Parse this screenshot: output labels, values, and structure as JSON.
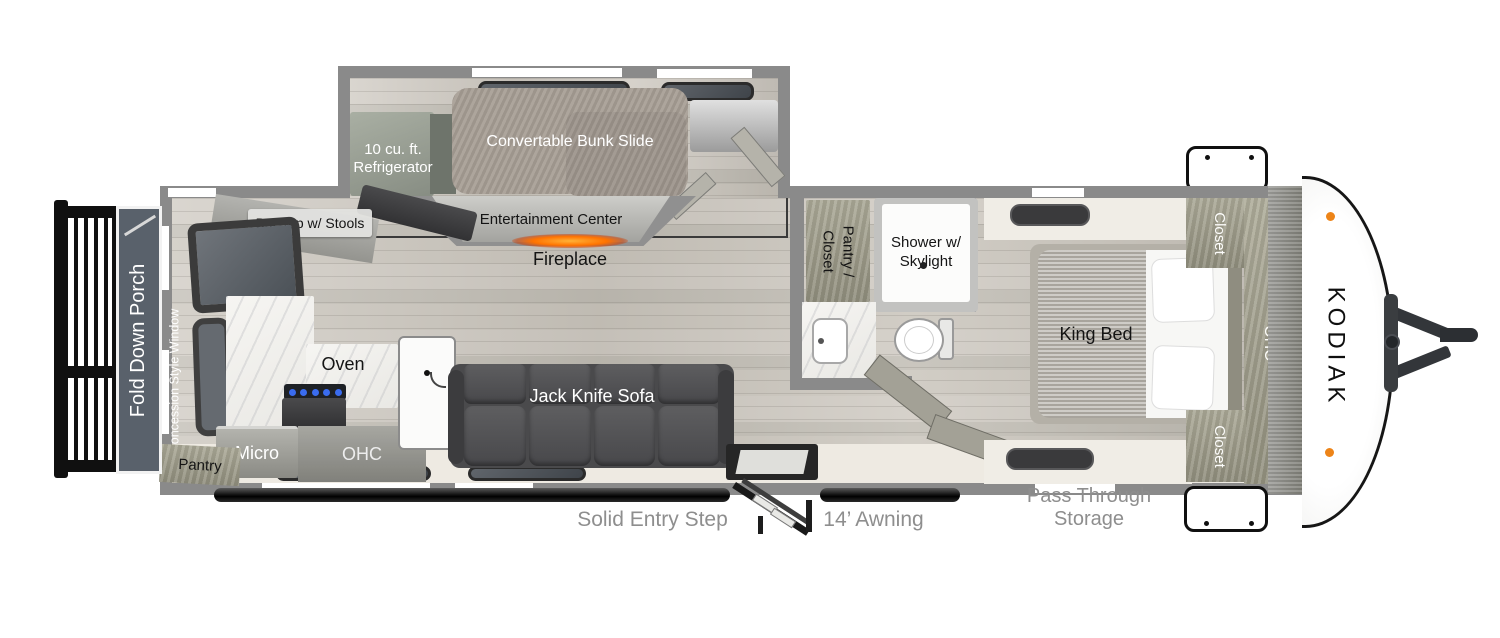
{
  "plan": {
    "brand": "KODIAK",
    "bunk_room": {
      "refrigerator_label": "10 cu. ft. Refrigerator",
      "bunk_label": "Convertable Bunk Slide",
      "entertainment_label": "Entertainment Center",
      "fireplace_label": "Fireplace"
    },
    "kitchen": {
      "bar_top_label": "Bar Top w/ Stools",
      "oven_label": "Oven",
      "micro_label": "Micro",
      "ohc_label": "OHC",
      "pantry_label": "Pantry",
      "window_label": "Concession Style Window"
    },
    "living": {
      "sofa_label": "Jack Knife Sofa"
    },
    "bathroom": {
      "pantry_closet_line1": "Pantry /",
      "pantry_closet_line2": "Closet",
      "shower_label": "Shower w/ Skylight"
    },
    "bedroom": {
      "bed_label": "King Bed",
      "closet_top_label": "Closet",
      "ohc_label": "OHC",
      "closet_bottom_label": "Closet"
    },
    "exterior": {
      "porch_label": "Fold Down Porch",
      "entry_step_label": "Solid Entry Step",
      "awning_label": "14’ Awning",
      "storage_label": "Pass Through Storage"
    },
    "colors": {
      "wall": "#8a8a8a",
      "floor": "#c7c3ba",
      "sofa": "#4a4a4c",
      "porch": "#59616b",
      "cabinet": "#9c9a8a",
      "fireplace_glow": "#ff7300",
      "exterior_label": "#8e8e8e",
      "marker_light": "#ed8418"
    }
  }
}
